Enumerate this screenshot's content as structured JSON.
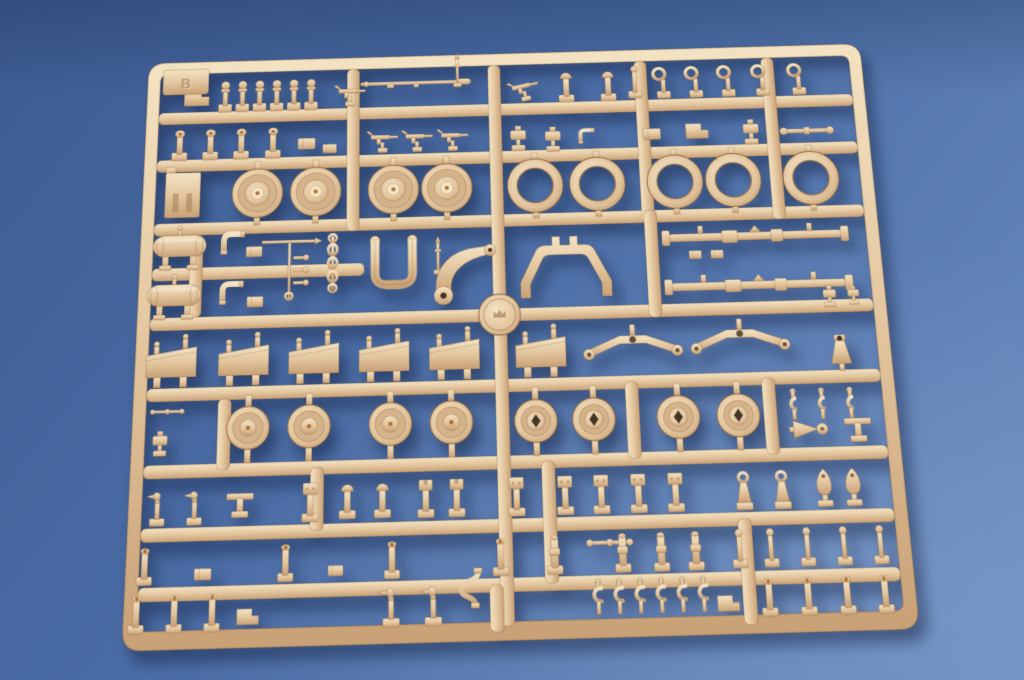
{
  "scene": {
    "subject": "Injection-molded model kit parts sprue (tan styrene parts tree) photographed on a plain blue backdrop",
    "background": "seamless blue paper, lighter toward lower right",
    "lighting": "soft studio light from upper left with drop shadow below the sprue"
  },
  "colors": {
    "background_top": "#3e5c93",
    "background_mid": "#4a6ca5",
    "background_bottom": "#6b8ec2",
    "plastic_light": "#f4e3c2",
    "plastic_mid": "#e4c7a0",
    "plastic_dark": "#c9a176",
    "plastic_deep": "#9e7850",
    "plastic_outline": "#8f6a42",
    "plastic_dish": "#d4b28a",
    "hole_dark": "#463626",
    "ejector_dot": "#b06c32",
    "shadow": "rgba(15,30,62,0.5)"
  },
  "sprue": {
    "letter": "B",
    "material": "tan injection-molded styrene",
    "frame": {
      "x": 4,
      "y": 4,
      "w": 752,
      "h": 592,
      "corner_radius": 18,
      "rail_width": 13
    },
    "tilt_deg": -1.6,
    "disc": {
      "cx": 368,
      "cy": 284,
      "r": 21
    },
    "h_rails": [
      {
        "x1": 17,
        "x2": 743,
        "y": 60
      },
      {
        "x1": 17,
        "x2": 743,
        "y": 112
      },
      {
        "x1": 17,
        "x2": 743,
        "y": 180
      },
      {
        "x1": 17,
        "x2": 232,
        "y": 227
      },
      {
        "x1": 17,
        "x2": 743,
        "y": 278
      },
      {
        "x1": 17,
        "x2": 743,
        "y": 349
      },
      {
        "x1": 17,
        "x2": 743,
        "y": 424
      },
      {
        "x1": 17,
        "x2": 743,
        "y": 484
      },
      {
        "x1": 17,
        "x2": 743,
        "y": 539
      }
    ],
    "v_rails": [
      {
        "x": 214,
        "y1": 17,
        "y2": 193
      },
      {
        "x": 362,
        "y1": 17,
        "y2": 583
      },
      {
        "x": 516,
        "y1": 17,
        "y2": 193
      },
      {
        "x": 650,
        "y1": 17,
        "y2": 193
      },
      {
        "x": 55,
        "y1": 193,
        "y2": 278
      },
      {
        "x": 518,
        "y1": 180,
        "y2": 291
      },
      {
        "x": 88,
        "y1": 361,
        "y2": 430
      },
      {
        "x": 490,
        "y1": 355,
        "y2": 430
      },
      {
        "x": 625,
        "y1": 355,
        "y2": 430
      },
      {
        "x": 180,
        "y1": 430,
        "y2": 490
      },
      {
        "x": 405,
        "y1": 430,
        "y2": 545
      },
      {
        "x": 352,
        "y1": 545,
        "y2": 588
      },
      {
        "x": 592,
        "y1": 490,
        "y2": 588
      }
    ],
    "inventory": {
      "solid_road_wheels": 4,
      "open_drum_rings": 5,
      "hub_cap_wheels": 4,
      "diamond_hole_wheels": 4,
      "angled_shield_plates": 6,
      "equalizer_arms": 2,
      "tow_eyelets": 5,
      "c_clamps": 6,
      "u_clamps": 3,
      "fuel_tanks": 2,
      "long_axle_rods": 2,
      "gun_cradle_arch": 1,
      "u_yoke": 1,
      "swing_arm": 1,
      "chain_of_links": 1,
      "runner_logo_disc": 1,
      "corner_letter_tab": 1,
      "small_fittings_approx": 90
    },
    "parts": [
      {
        "t": "block_l",
        "x": 56,
        "y": 44
      },
      {
        "t": "peg_ball",
        "x": 86,
        "y": 44
      },
      {
        "t": "peg_ball",
        "x": 104,
        "y": 44
      },
      {
        "t": "peg_ball",
        "x": 122,
        "y": 44
      },
      {
        "t": "peg_ball",
        "x": 140,
        "y": 44
      },
      {
        "t": "peg_ball",
        "x": 158,
        "y": 44
      },
      {
        "t": "peg_ball",
        "x": 176,
        "y": 44
      },
      {
        "t": "gun",
        "x": 216,
        "y": 42
      },
      {
        "t": "rod_thin",
        "x": 286,
        "y": 34
      },
      {
        "t": "mast",
        "x": 330,
        "y": 22,
        "s": 0.85
      },
      {
        "t": "gun",
        "x": 398,
        "y": 42,
        "r": -12
      },
      {
        "t": "post_dome",
        "x": 444,
        "y": 42
      },
      {
        "t": "post_dome",
        "x": 488,
        "y": 42
      },
      {
        "t": "post_ball",
        "x": 516,
        "y": 40
      },
      {
        "t": "eyelet",
        "x": 546,
        "y": 44
      },
      {
        "t": "eyelet",
        "x": 580,
        "y": 44
      },
      {
        "t": "eyelet",
        "x": 614,
        "y": 44
      },
      {
        "t": "eyelet",
        "x": 650,
        "y": 44
      },
      {
        "t": "eyelet",
        "x": 688,
        "y": 44
      },
      {
        "t": "peg_knob",
        "x": 40,
        "y": 96
      },
      {
        "t": "peg_knob",
        "x": 72,
        "y": 96
      },
      {
        "t": "peg_knob",
        "x": 104,
        "y": 96
      },
      {
        "t": "peg_knob",
        "x": 137,
        "y": 96
      },
      {
        "t": "block_s",
        "x": 172,
        "y": 98
      },
      {
        "t": "block_s",
        "x": 196,
        "y": 104,
        "s": 0.8
      },
      {
        "t": "gun",
        "x": 250,
        "y": 94
      },
      {
        "t": "gun",
        "x": 286,
        "y": 94
      },
      {
        "t": "gun",
        "x": 323,
        "y": 94
      },
      {
        "t": "misc_s",
        "x": 392,
        "y": 95
      },
      {
        "t": "misc_s",
        "x": 428,
        "y": 97
      },
      {
        "t": "elbow",
        "x": 463,
        "y": 98,
        "s": 0.7
      },
      {
        "t": "block_s",
        "x": 531,
        "y": 98
      },
      {
        "t": "block_l",
        "x": 578,
        "y": 96,
        "s": 0.9
      },
      {
        "t": "misc_s",
        "x": 634,
        "y": 95
      },
      {
        "t": "hbar",
        "x": 692,
        "y": 99
      },
      {
        "t": "slot_block",
        "x": 45,
        "y": 150
      },
      {
        "t": "wheel_solid",
        "x": 122,
        "y": 150
      },
      {
        "t": "wheel_solid",
        "x": 182,
        "y": 150
      },
      {
        "t": "wheel_solid",
        "x": 262,
        "y": 150
      },
      {
        "t": "wheel_solid",
        "x": 317,
        "y": 150
      },
      {
        "t": "ring_open",
        "x": 408,
        "y": 150
      },
      {
        "t": "ring_open",
        "x": 472,
        "y": 150
      },
      {
        "t": "ring_open",
        "x": 552,
        "y": 150
      },
      {
        "t": "ring_open",
        "x": 612,
        "y": 150
      },
      {
        "t": "ring_open",
        "x": 692,
        "y": 150
      },
      {
        "t": "tank",
        "x": 44,
        "y": 204
      },
      {
        "t": "tank",
        "x": 40,
        "y": 255
      },
      {
        "t": "elbow",
        "x": 98,
        "y": 202
      },
      {
        "t": "elbow",
        "x": 98,
        "y": 254
      },
      {
        "t": "block_s",
        "x": 120,
        "y": 212,
        "s": 0.9
      },
      {
        "t": "block_s",
        "x": 122,
        "y": 264,
        "s": 0.9
      },
      {
        "t": "tree",
        "x": 156,
        "y": 232
      },
      {
        "t": "chain",
        "x": 200,
        "y": 228
      },
      {
        "t": "yoke",
        "x": 262,
        "y": 234
      },
      {
        "t": "mast",
        "x": 307,
        "y": 222,
        "s": 0.9
      },
      {
        "t": "swing_arm",
        "x": 333,
        "y": 236
      },
      {
        "t": "arch",
        "x": 436,
        "y": 240
      },
      {
        "t": "axle",
        "x": 630,
        "y": 210
      },
      {
        "t": "axle",
        "x": 630,
        "y": 261
      },
      {
        "t": "block_s",
        "x": 568,
        "y": 228,
        "s": 0.7
      },
      {
        "t": "block_s",
        "x": 590,
        "y": 228,
        "s": 0.7
      },
      {
        "t": "misc_s",
        "x": 700,
        "y": 272,
        "s": 0.8
      },
      {
        "t": "misc_s",
        "x": 724,
        "y": 272,
        "s": 0.7
      },
      {
        "t": "plate_angled",
        "x": 40,
        "y": 324
      },
      {
        "t": "plate_angled",
        "x": 112,
        "y": 324
      },
      {
        "t": "plate_angled",
        "x": 182,
        "y": 324
      },
      {
        "t": "plate_angled",
        "x": 252,
        "y": 324
      },
      {
        "t": "plate_angled",
        "x": 322,
        "y": 324
      },
      {
        "t": "plate_angled",
        "x": 408,
        "y": 324
      },
      {
        "t": "equalizer",
        "x": 500,
        "y": 320
      },
      {
        "t": "equalizer",
        "x": 607,
        "y": 317
      },
      {
        "t": "cone_plug",
        "x": 706,
        "y": 330
      },
      {
        "t": "hbar",
        "x": 38,
        "y": 372,
        "s": 0.6
      },
      {
        "t": "misc_s",
        "x": 32,
        "y": 400,
        "s": 0.9
      },
      {
        "t": "wheel_hub",
        "x": 118,
        "y": 390
      },
      {
        "t": "wheel_hub",
        "x": 178,
        "y": 390
      },
      {
        "t": "wheel_hub",
        "x": 258,
        "y": 390
      },
      {
        "t": "wheel_hub",
        "x": 318,
        "y": 390
      },
      {
        "t": "wheel_diamond",
        "x": 401,
        "y": 391
      },
      {
        "t": "wheel_diamond",
        "x": 458,
        "y": 391
      },
      {
        "t": "wheel_diamond",
        "x": 541,
        "y": 391
      },
      {
        "t": "wheel_diamond",
        "x": 600,
        "y": 391
      },
      {
        "t": "clamp_u",
        "x": 655,
        "y": 381
      },
      {
        "t": "clamp_u",
        "x": 683,
        "y": 381
      },
      {
        "t": "clamp_u",
        "x": 711,
        "y": 381
      },
      {
        "t": "funnel",
        "x": 670,
        "y": 408
      },
      {
        "t": "bracket_t",
        "x": 716,
        "y": 406
      },
      {
        "t": "duck",
        "x": 32,
        "y": 464,
        "s": 0.9
      },
      {
        "t": "duck",
        "x": 68,
        "y": 464,
        "s": 0.9
      },
      {
        "t": "bracket_t",
        "x": 112,
        "y": 462
      },
      {
        "t": "post_square",
        "x": 180,
        "y": 462
      },
      {
        "t": "post_dome",
        "x": 216,
        "y": 462
      },
      {
        "t": "post_dome",
        "x": 250,
        "y": 462
      },
      {
        "t": "post_cup",
        "x": 292,
        "y": 462
      },
      {
        "t": "post_cup",
        "x": 322,
        "y": 462
      },
      {
        "t": "post_square",
        "x": 380,
        "y": 462
      },
      {
        "t": "post_square",
        "x": 427,
        "y": 462
      },
      {
        "t": "post_square",
        "x": 462,
        "y": 462
      },
      {
        "t": "post_square",
        "x": 498,
        "y": 462
      },
      {
        "t": "post_square",
        "x": 534,
        "y": 462
      },
      {
        "t": "aframe",
        "x": 600,
        "y": 464
      },
      {
        "t": "aframe",
        "x": 637,
        "y": 464
      },
      {
        "t": "shield",
        "x": 678,
        "y": 461
      },
      {
        "t": "shield",
        "x": 706,
        "y": 461
      },
      {
        "t": "post_dot",
        "x": 22,
        "y": 518
      },
      {
        "t": "post_dot",
        "x": 157,
        "y": 518
      },
      {
        "t": "post_dot",
        "x": 259,
        "y": 518
      },
      {
        "t": "post_dot",
        "x": 363,
        "y": 518
      },
      {
        "t": "block_s",
        "x": 78,
        "y": 528,
        "s": 0.9
      },
      {
        "t": "block_s",
        "x": 205,
        "y": 528,
        "s": 0.8
      },
      {
        "t": "hbar",
        "x": 468,
        "y": 509,
        "s": 0.8
      },
      {
        "t": "post_collar",
        "x": 415,
        "y": 517
      },
      {
        "t": "post_collar",
        "x": 480,
        "y": 517
      },
      {
        "t": "post_collar",
        "x": 517,
        "y": 517
      },
      {
        "t": "post_collar",
        "x": 550,
        "y": 517
      },
      {
        "t": "post_ball",
        "x": 592,
        "y": 518
      },
      {
        "t": "post_ball",
        "x": 622,
        "y": 518
      },
      {
        "t": "post_ball",
        "x": 657,
        "y": 518
      },
      {
        "t": "post_ball",
        "x": 692,
        "y": 518
      },
      {
        "t": "post_ball",
        "x": 727,
        "y": 518
      },
      {
        "t": "post_dot",
        "x": 16,
        "y": 562
      },
      {
        "t": "post_dot",
        "x": 52,
        "y": 562
      },
      {
        "t": "post_dot",
        "x": 88,
        "y": 562
      },
      {
        "t": "block_l",
        "x": 122,
        "y": 568,
        "s": 0.8
      },
      {
        "t": "duck",
        "x": 258,
        "y": 561
      },
      {
        "t": "duck",
        "x": 298,
        "y": 561
      },
      {
        "t": "tube_s",
        "x": 332,
        "y": 549
      },
      {
        "t": "clamp_c",
        "x": 455,
        "y": 560
      },
      {
        "t": "clamp_c",
        "x": 475,
        "y": 560
      },
      {
        "t": "clamp_c",
        "x": 495,
        "y": 560
      },
      {
        "t": "clamp_c",
        "x": 515,
        "y": 560
      },
      {
        "t": "clamp_c",
        "x": 535,
        "y": 560
      },
      {
        "t": "clamp_c",
        "x": 555,
        "y": 560
      },
      {
        "t": "block_l",
        "x": 578,
        "y": 568,
        "s": 0.8
      },
      {
        "t": "post_dot",
        "x": 617,
        "y": 562
      },
      {
        "t": "post_dot",
        "x": 654,
        "y": 562
      },
      {
        "t": "post_dot",
        "x": 691,
        "y": 562
      },
      {
        "t": "post_dot",
        "x": 727,
        "y": 562
      }
    ]
  }
}
